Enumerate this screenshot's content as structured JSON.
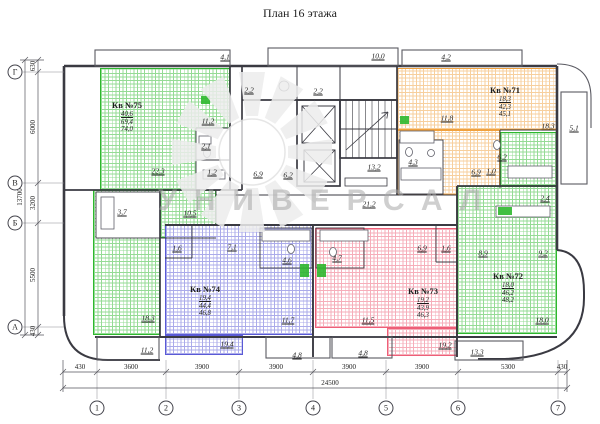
{
  "title": "План 16 этажа",
  "watermark": {
    "text": "УНИВЕРСАЛ"
  },
  "colors": {
    "green": "#2eb82e",
    "orange": "#f0a13e",
    "blue": "#5a5ad6",
    "red": "#ee5f78",
    "wall": "#3a3a42",
    "dim": "#55555c",
    "ink": "#1d1d1d",
    "watermark": "#a8a8a8"
  },
  "apartments": [
    {
      "name": "Кв №75",
      "stats": [
        "40,6",
        "69,4",
        "74,0"
      ],
      "x": 127,
      "y": 100
    },
    {
      "name": "Кв №71",
      "stats": [
        "18,3",
        "42,3",
        "45,1"
      ],
      "x": 505,
      "y": 85
    },
    {
      "name": "Кв №72",
      "stats": [
        "18,0",
        "46,2",
        "48,2"
      ],
      "x": 508,
      "y": 271
    },
    {
      "name": "Кв №74",
      "stats": [
        "19,4",
        "44,4",
        "46,8"
      ],
      "x": 205,
      "y": 284
    },
    {
      "name": "Кв №73",
      "stats": [
        "19,2",
        "43,9",
        "46,3"
      ],
      "x": 423,
      "y": 286
    }
  ],
  "room_labels": [
    {
      "text": "4,1",
      "x": 225,
      "y": 57
    },
    {
      "text": "10,0",
      "x": 378,
      "y": 56
    },
    {
      "text": "4,2",
      "x": 446,
      "y": 57
    },
    {
      "text": "2,2",
      "x": 249,
      "y": 90
    },
    {
      "text": "2,2",
      "x": 318,
      "y": 91
    },
    {
      "text": "11,2",
      "x": 208,
      "y": 121
    },
    {
      "text": "22,3",
      "x": 158,
      "y": 171
    },
    {
      "text": "2,1",
      "x": 206,
      "y": 146
    },
    {
      "text": "1,2",
      "x": 212,
      "y": 172
    },
    {
      "text": "3,7",
      "x": 122,
      "y": 212
    },
    {
      "text": "10,5",
      "x": 190,
      "y": 213
    },
    {
      "text": "18,3",
      "x": 148,
      "y": 318
    },
    {
      "text": "11,2",
      "x": 147,
      "y": 350
    },
    {
      "text": "6,9",
      "x": 258,
      "y": 174
    },
    {
      "text": "6,2",
      "x": 288,
      "y": 175
    },
    {
      "text": "13,2",
      "x": 374,
      "y": 167
    },
    {
      "text": "21,2",
      "x": 369,
      "y": 204
    },
    {
      "text": "11,8",
      "x": 447,
      "y": 118
    },
    {
      "text": "18,3",
      "x": 548,
      "y": 126
    },
    {
      "text": "5,1",
      "x": 574,
      "y": 128
    },
    {
      "text": "4,3",
      "x": 413,
      "y": 162
    },
    {
      "text": "6,9",
      "x": 476,
      "y": 172
    },
    {
      "text": "1,0",
      "x": 491,
      "y": 171
    },
    {
      "text": "6,2",
      "x": 502,
      "y": 157
    },
    {
      "text": "2,4",
      "x": 545,
      "y": 198
    },
    {
      "text": "8,9",
      "x": 483,
      "y": 253
    },
    {
      "text": "9,2",
      "x": 543,
      "y": 253
    },
    {
      "text": "18,0",
      "x": 542,
      "y": 320
    },
    {
      "text": "13,3",
      "x": 477,
      "y": 352
    },
    {
      "text": "1,6",
      "x": 177,
      "y": 248
    },
    {
      "text": "7,1",
      "x": 232,
      "y": 247
    },
    {
      "text": "4,6",
      "x": 287,
      "y": 260
    },
    {
      "text": "11,7",
      "x": 288,
      "y": 320
    },
    {
      "text": "19,4",
      "x": 227,
      "y": 344
    },
    {
      "text": "4,8",
      "x": 297,
      "y": 355
    },
    {
      "text": "4,7",
      "x": 337,
      "y": 258
    },
    {
      "text": "6,9",
      "x": 422,
      "y": 248
    },
    {
      "text": "1,6",
      "x": 446,
      "y": 248
    },
    {
      "text": "11,5",
      "x": 368,
      "y": 320
    },
    {
      "text": "19,2",
      "x": 445,
      "y": 345
    },
    {
      "text": "4,8",
      "x": 363,
      "y": 353
    }
  ],
  "axis": {
    "bottom": [
      {
        "label": "1",
        "x": 97
      },
      {
        "label": "2",
        "x": 166
      },
      {
        "label": "3",
        "x": 239
      },
      {
        "label": "4",
        "x": 313
      },
      {
        "label": "5",
        "x": 386
      },
      {
        "label": "6",
        "x": 458
      },
      {
        "label": "7",
        "x": 558
      }
    ],
    "left": [
      {
        "label": "Г",
        "y": 72
      },
      {
        "label": "В",
        "y": 183
      },
      {
        "label": "Б",
        "y": 223
      },
      {
        "label": "А",
        "y": 327
      }
    ]
  },
  "dims": {
    "bottom": {
      "labels": [
        {
          "v": "430",
          "x": 80
        },
        {
          "v": "3600",
          "x": 131
        },
        {
          "v": "3900",
          "x": 202
        },
        {
          "v": "3900",
          "x": 276
        },
        {
          "v": "3900",
          "x": 349
        },
        {
          "v": "3900",
          "x": 422
        },
        {
          "v": "5300",
          "x": 508
        },
        {
          "v": "430",
          "x": 562
        }
      ],
      "total": "24500",
      "total_x": 330
    },
    "left": {
      "labels": [
        {
          "v": "630",
          "y": 66
        },
        {
          "v": "6000",
          "y": 127
        },
        {
          "v": "3200",
          "y": 203
        },
        {
          "v": "5500",
          "y": 275
        },
        {
          "v": "430",
          "y": 331
        }
      ],
      "total": "13700",
      "total_y": 197
    }
  }
}
